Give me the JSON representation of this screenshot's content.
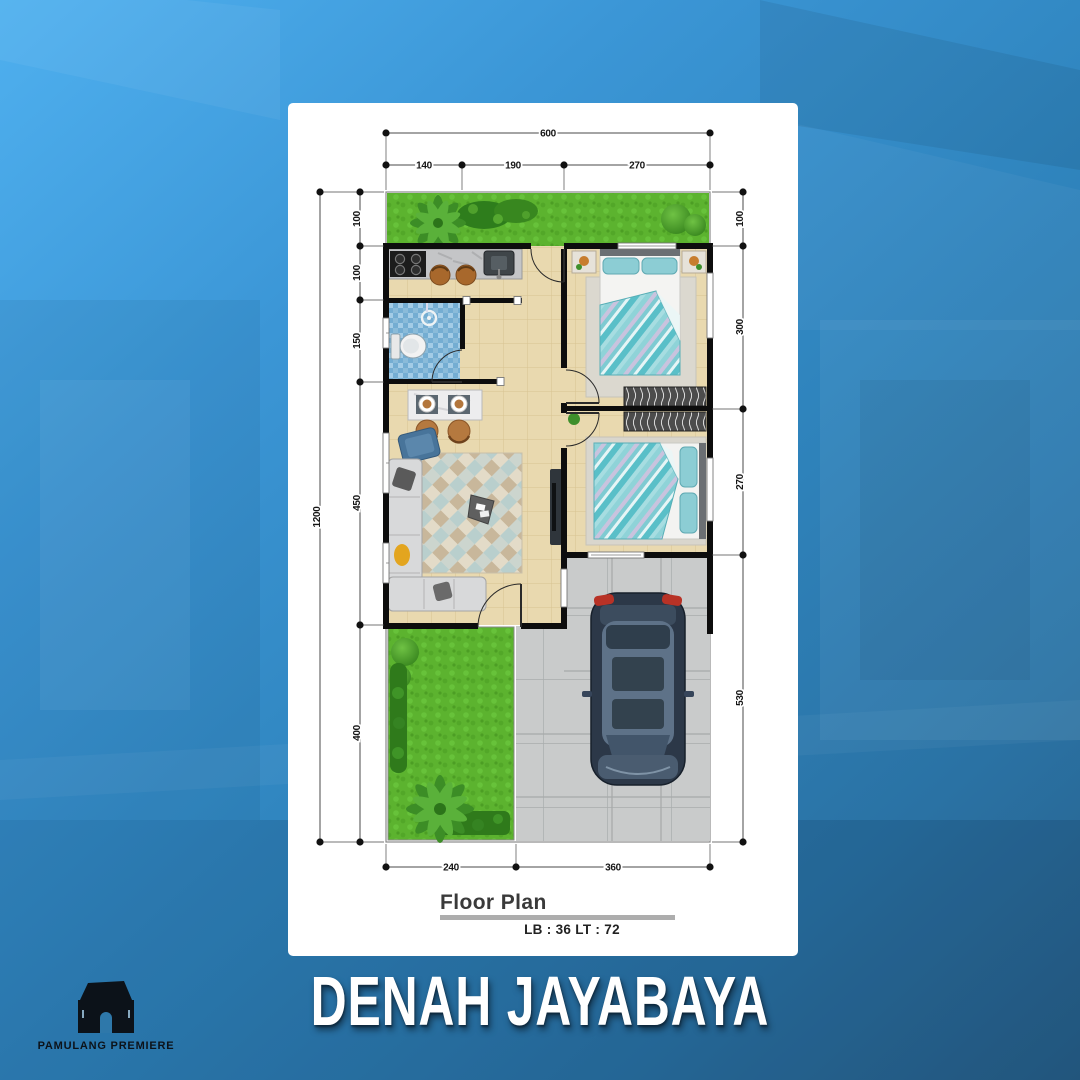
{
  "banner": {
    "title": "DENAH JAYABAYA"
  },
  "logo": {
    "brand": "PAMULANG PREMIERE",
    "icon": "house-icon"
  },
  "floor_plan": {
    "caption": "Floor Plan",
    "area_label": "LB : 36 LT : 72",
    "dims": {
      "top_total": "600",
      "top_segments": [
        "140",
        "190",
        "270"
      ],
      "left_total": "1200",
      "left_segments": [
        "100",
        "100",
        "150",
        "450",
        "400"
      ],
      "right_segments": [
        "100",
        "300",
        "270",
        "530"
      ],
      "bottom_segments": [
        "240",
        "360"
      ]
    }
  },
  "colors": {
    "background_blue": "#2f84bd",
    "card": "#ffffff",
    "grass_green": "#5cb32f",
    "bathroom_tile_blue": "#74add2",
    "floor_beige": "#e9d9af",
    "carport_gray": "#c9cbcb",
    "wall_black": "#0d0d0d",
    "car_body_navy": "#2c3848",
    "tail_light_red": "#b83226"
  }
}
